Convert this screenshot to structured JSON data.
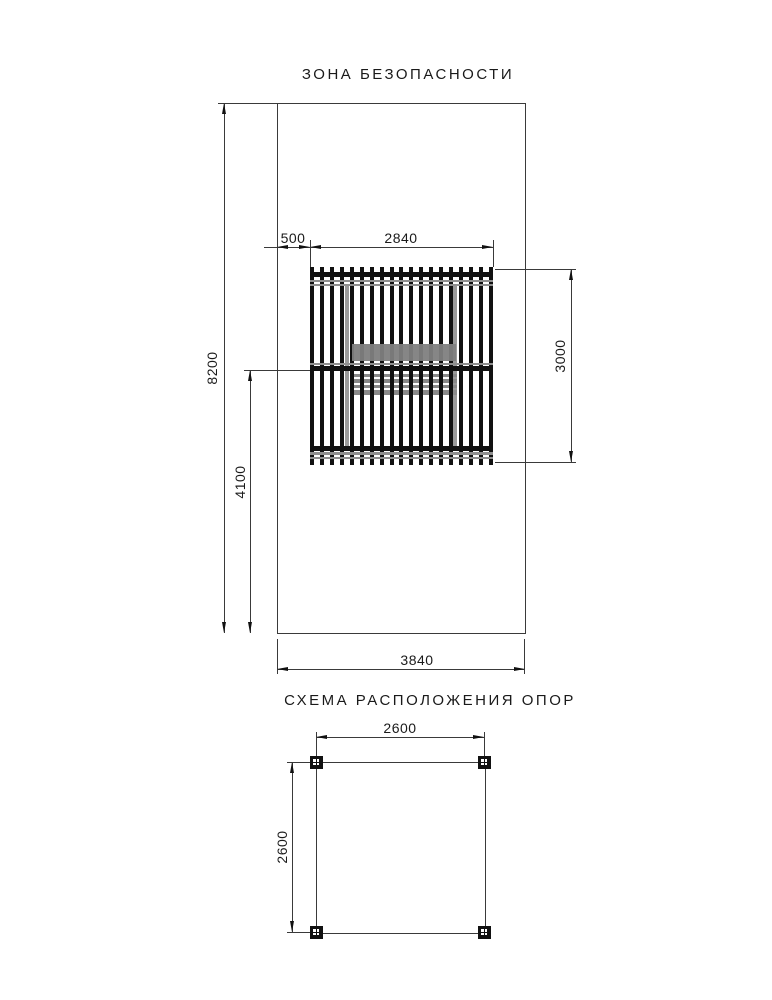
{
  "page": {
    "background": "#ffffff",
    "line_color": "#3a3a3a",
    "ink_color": "#111111",
    "gray_color": "#8f8f8f"
  },
  "safety_zone": {
    "title": "ЗОНА БЕЗОПАСНОСТИ",
    "dims": {
      "edge_offset": "500",
      "structure_width": "2840",
      "zone_height": "8200",
      "mid_to_bottom": "4100",
      "structure_depth": "3000",
      "zone_width": "3840"
    },
    "structure": {
      "slat_count": 19,
      "slat_color": "#111111",
      "table_color": "#858585",
      "bench_count": 4
    }
  },
  "support_scheme": {
    "title": "СХЕМА РАСПОЛОЖЕНИЯ ОПОР",
    "dims": {
      "span_x": "2600",
      "span_y": "2600"
    },
    "post_count": 4
  }
}
